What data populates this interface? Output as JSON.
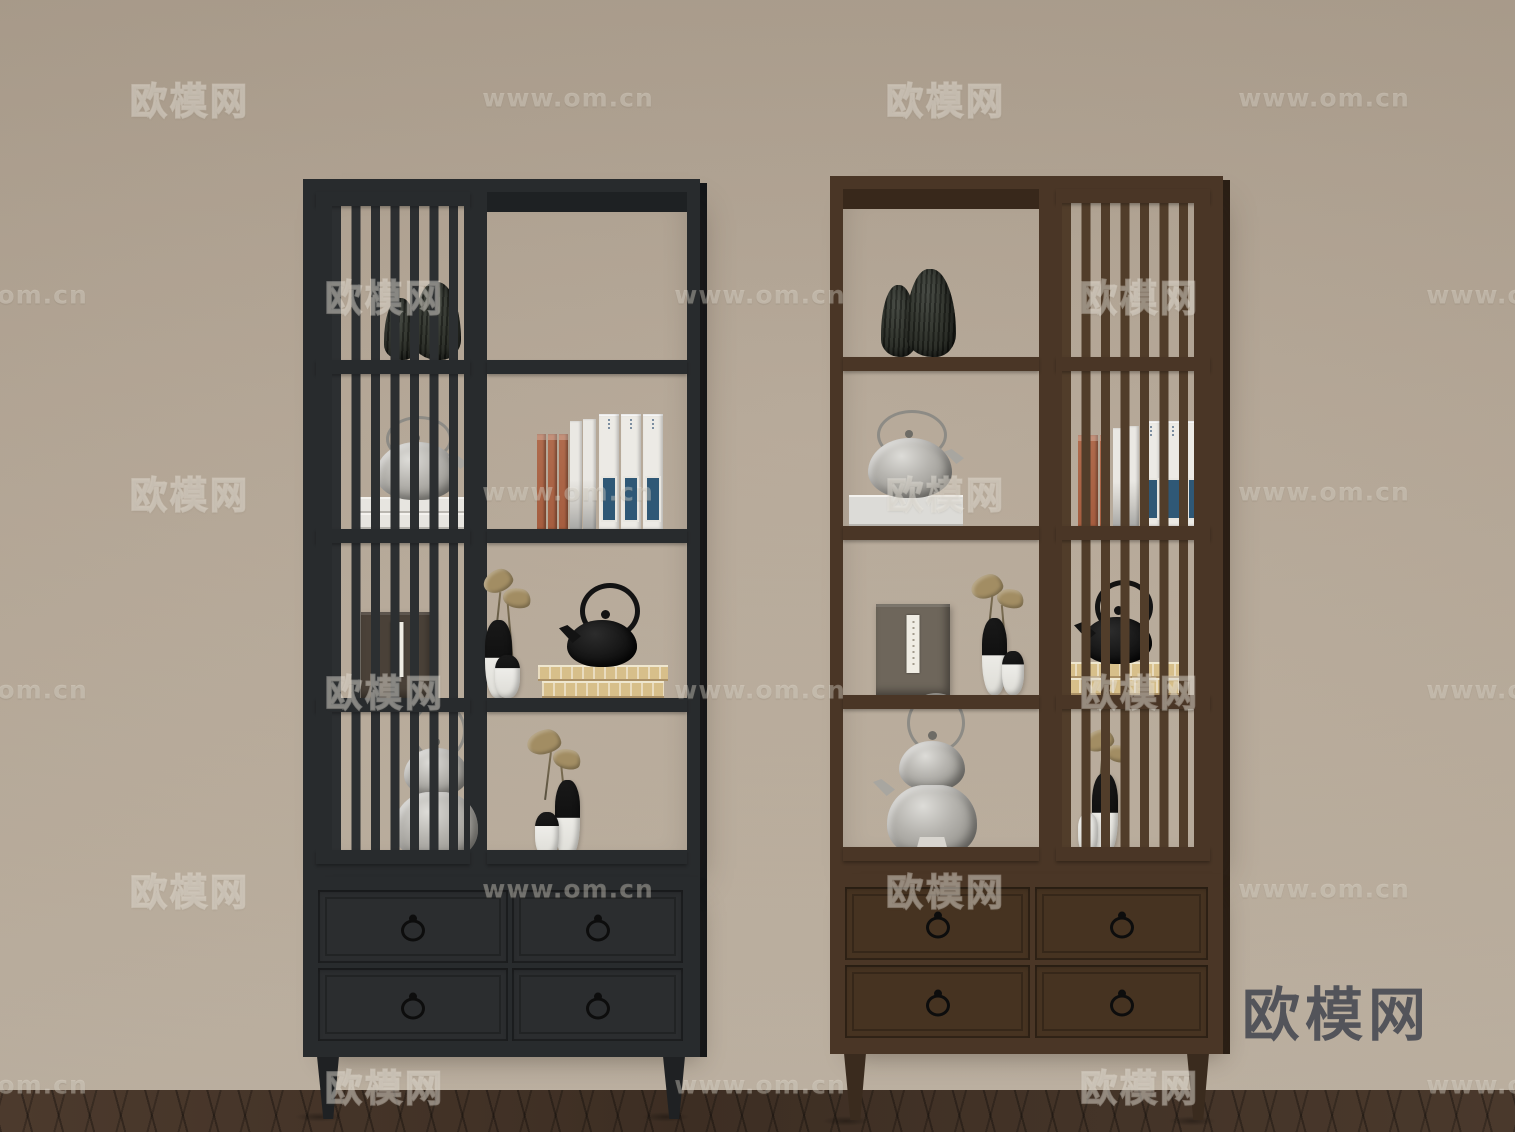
{
  "logo": {
    "text": "欧模网",
    "color": "#53545a"
  },
  "source_watermark": {
    "site_name": "欧模网",
    "site_url": "www.om.cn",
    "rows": [
      {
        "y": 98,
        "items": [
          {
            "text": "欧模网",
            "x": 190
          },
          {
            "text": "www.om.cn",
            "x": 568
          },
          {
            "text": "欧模网",
            "x": 946
          },
          {
            "text": "www.om.cn",
            "x": 1324
          }
        ]
      },
      {
        "y": 295,
        "items": [
          {
            "text": "www.om.cn",
            "x": 2
          },
          {
            "text": "欧模网",
            "x": 385
          },
          {
            "text": "www.om.cn",
            "x": 760
          },
          {
            "text": "欧模网",
            "x": 1140
          },
          {
            "text": "www.om.cn",
            "x": 1512
          }
        ]
      },
      {
        "y": 492,
        "items": [
          {
            "text": "欧模网",
            "x": 190
          },
          {
            "text": "www.om.cn",
            "x": 568
          },
          {
            "text": "欧模网",
            "x": 946
          },
          {
            "text": "www.om.cn",
            "x": 1324
          }
        ]
      },
      {
        "y": 690,
        "items": [
          {
            "text": "www.om.cn",
            "x": 2
          },
          {
            "text": "欧模网",
            "x": 385
          },
          {
            "text": "www.om.cn",
            "x": 760
          },
          {
            "text": "欧模网",
            "x": 1140
          },
          {
            "text": "www.om.cn",
            "x": 1512
          }
        ]
      },
      {
        "y": 889,
        "items": [
          {
            "text": "欧模网",
            "x": 190
          },
          {
            "text": "www.om.cn",
            "x": 568
          },
          {
            "text": "欧模网",
            "x": 946
          },
          {
            "text": "www.om.cn",
            "x": 1324
          }
        ]
      },
      {
        "y": 1085,
        "items": [
          {
            "text": "www.om.cn",
            "x": 2
          },
          {
            "text": "欧模网",
            "x": 385
          },
          {
            "text": "www.om.cn",
            "x": 760
          },
          {
            "text": "欧模网",
            "x": 1140
          },
          {
            "text": "www.om.cn",
            "x": 1512
          }
        ]
      }
    ]
  },
  "scene": {
    "wall_color": "#b3a594",
    "floor_color": "#46352a",
    "cabinets": [
      {
        "name": "black display cabinet",
        "finish_color": "#282b2d",
        "slat_door_side": "left",
        "drawers": 4,
        "shelf_rows": 4
      },
      {
        "name": "brown wood display cabinet",
        "finish_color": "#4a3626",
        "slat_door_side": "right",
        "drawers": 4,
        "shelf_rows": 4
      }
    ]
  }
}
